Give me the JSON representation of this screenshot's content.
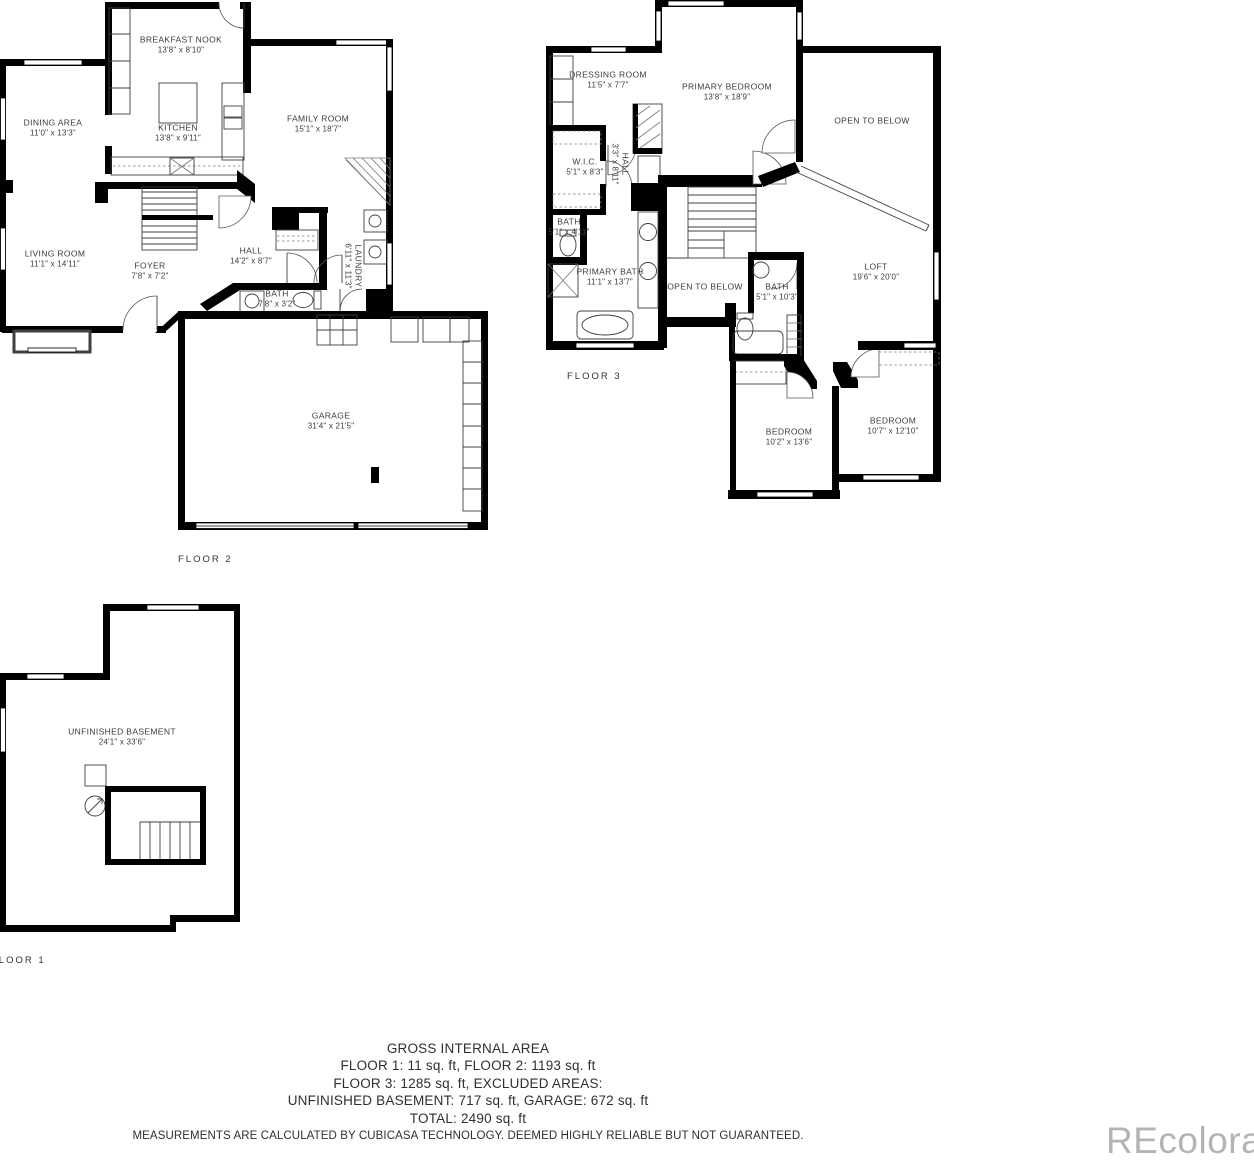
{
  "watermark": "REcolorado",
  "colors": {
    "wall": "#000000",
    "fixture_line": "#3f3f3f",
    "label_text": "#3b3b3b",
    "watermark_gray": "#b4b4b4"
  },
  "floors": {
    "f2": {
      "tag": "FLOOR 2",
      "rooms": {
        "breakfast_nook": {
          "name": "BREAKFAST NOOK",
          "dims": "13'8\" x 8'10\""
        },
        "dining_area": {
          "name": "DINING AREA",
          "dims": "11'0\" x 13'3\""
        },
        "kitchen": {
          "name": "KITCHEN",
          "dims": "13'8\" x 9'11\""
        },
        "family_room": {
          "name": "FAMILY ROOM",
          "dims": "15'1\" x 18'7\""
        },
        "living_room": {
          "name": "LIVING ROOM",
          "dims": "11'1\" x 14'11\""
        },
        "foyer": {
          "name": "FOYER",
          "dims": "7'8\" x 7'2\""
        },
        "hall": {
          "name": "HALL",
          "dims": "14'2\" x 8'7\""
        },
        "bath": {
          "name": "BATH",
          "dims": "7'8\" x 3'2\""
        },
        "laundry": {
          "name": "LAUNDRY",
          "dims": "6'11\" x 11'3\""
        },
        "garage": {
          "name": "GARAGE",
          "dims": "31'4\" x 21'5\""
        }
      }
    },
    "f3": {
      "tag": "FLOOR 3",
      "rooms": {
        "dressing_room": {
          "name": "DRESSING ROOM",
          "dims": "11'5\" x 7'7\""
        },
        "primary_bedroom": {
          "name": "PRIMARY BEDROOM",
          "dims": "13'8\" x 18'9\""
        },
        "open_below_upper": {
          "name": "OPEN TO BELOW"
        },
        "wic": {
          "name": "W.I.C.",
          "dims": "5'1\" x 8'3\""
        },
        "hall": {
          "name": "HALL",
          "dims": "3'3\" x 8'11\""
        },
        "bath_small": {
          "name": "BATH",
          "dims": "5'1\" x 4'11\""
        },
        "primary_bath": {
          "name": "PRIMARY BATH",
          "dims": "11'1\" x 13'7\""
        },
        "open_below_mid": {
          "name": "OPEN TO BELOW"
        },
        "bath_hall": {
          "name": "BATH",
          "dims": "5'1\" x 10'3\""
        },
        "loft": {
          "name": "LOFT",
          "dims": "19'6\" x 20'0\""
        },
        "bedroom_a": {
          "name": "BEDROOM",
          "dims": "10'2\" x 13'6\""
        },
        "bedroom_b": {
          "name": "BEDROOM",
          "dims": "10'7\" x 12'10\""
        }
      }
    },
    "f1": {
      "tag": "FLOOR 1",
      "rooms": {
        "unfinished_basement": {
          "name": "UNFINISHED BASEMENT",
          "dims": "24'1\" x 33'6\""
        }
      }
    }
  },
  "summary": {
    "title": "GROSS INTERNAL AREA",
    "line1": "FLOOR 1: 11 sq. ft, FLOOR 2: 1193 sq. ft",
    "line2": "FLOOR 3: 1285 sq. ft, EXCLUDED AREAS:",
    "line3": "UNFINISHED BASEMENT: 717 sq. ft, GARAGE: 672 sq. ft",
    "line4": "TOTAL: 2490 sq. ft",
    "disclaimer": "MEASUREMENTS ARE CALCULATED BY CUBICASA TECHNOLOGY. DEEMED HIGHLY RELIABLE BUT NOT GUARANTEED."
  }
}
